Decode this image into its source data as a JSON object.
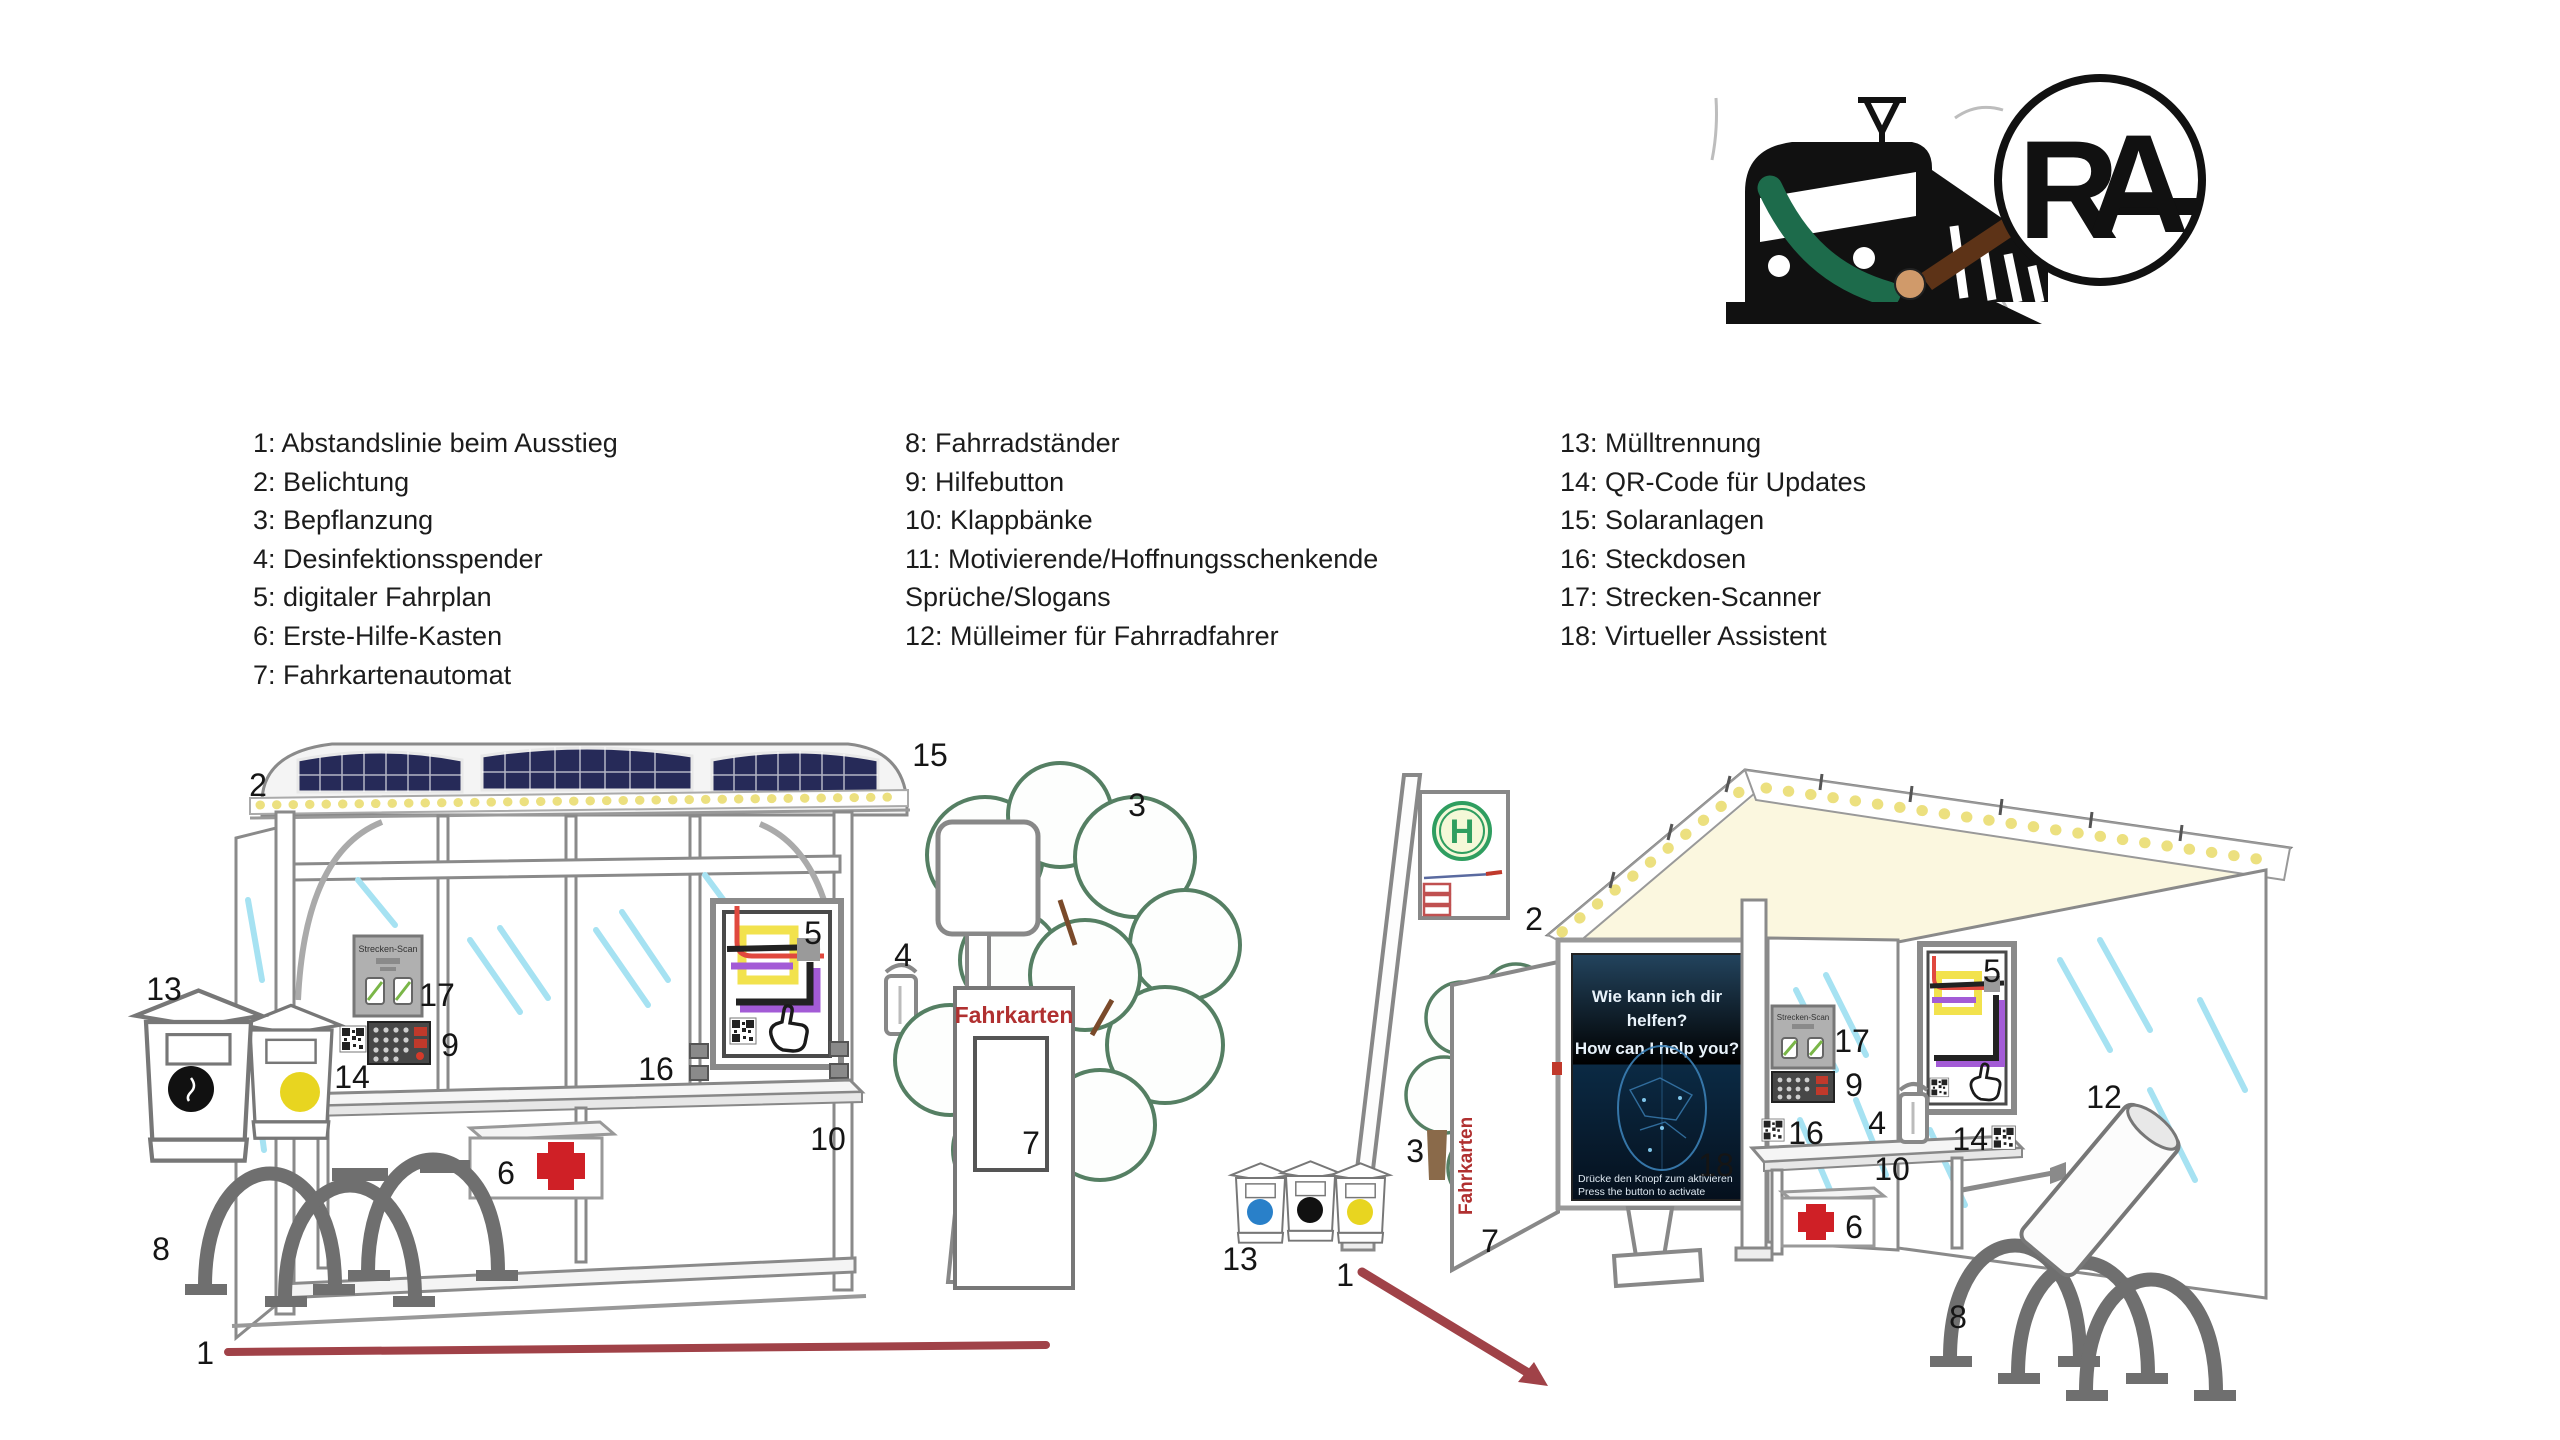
{
  "legend": {
    "column1": [
      "1: Abstandslinie beim Ausstieg",
      "2: Belichtung",
      "3: Bepflanzung",
      "4: Desinfektionsspender",
      "5: digitaler Fahrplan",
      "6: Erste-Hilfe-Kasten",
      "7: Fahrkartenautomat"
    ],
    "column2": [
      "8: Fahrradständer",
      "9: Hilfebutton",
      "10: Klappbänke",
      "11: Motivierende/Hoffnungsschenkende",
      "Sprüche/Slogans",
      "12: Mülleimer für Fahrradfahrer"
    ],
    "column3": [
      "13: Mülltrennung",
      "14: QR-Code für Updates",
      "15: Solaranlagen",
      "16: Steckdosen",
      "17: Strecken-Scanner",
      "18: Virtueller Assistent"
    ]
  },
  "callouts": {
    "n1": "1",
    "n2": "2",
    "n3": "3",
    "n4": "4",
    "n5": "5",
    "n6": "6",
    "n7": "7",
    "n8": "8",
    "n9": "9",
    "n10": "10",
    "n11": "11",
    "n12": "12",
    "n13": "13",
    "n14": "14",
    "n15": "15",
    "n16": "16",
    "n17": "17",
    "n18": "18"
  },
  "scene_left": {
    "streckenscan_label": "Strecken-Scan",
    "fahrkarten_label": "Fahrkarten"
  },
  "scene_right": {
    "h_sign_letter": "H",
    "streckenscan_label": "Strecken-Scan",
    "fahrkarten_label": "Fahrkarten",
    "poster": {
      "line1": "Wie kann ich dir",
      "line2": "helfen?",
      "line3": "How can I help you?",
      "footer1": "Drücke den Knopf zum aktivieren",
      "footer2": "Press the button to activate"
    }
  },
  "logos": {
    "rag_monogram": {
      "r": "R",
      "a": "A"
    }
  },
  "colors": {
    "solar_panel": "#262a58",
    "led_yellow": "#ece07f",
    "glass_streak": "#a6e2f2",
    "first_aid_red": "#cf2026",
    "fahrkarten_red": "#b03030",
    "distance_line_red": "#a04248",
    "route_red": "#e0483e",
    "route_yellow": "#f2e24d",
    "route_purple": "#a35bd6",
    "tree_green": "#557f63",
    "h_sign_green": "#2f9e60",
    "poster_blue_dark": "#06101d",
    "brush_brown": "#5d3317",
    "train_green": "#1d6b4b"
  }
}
